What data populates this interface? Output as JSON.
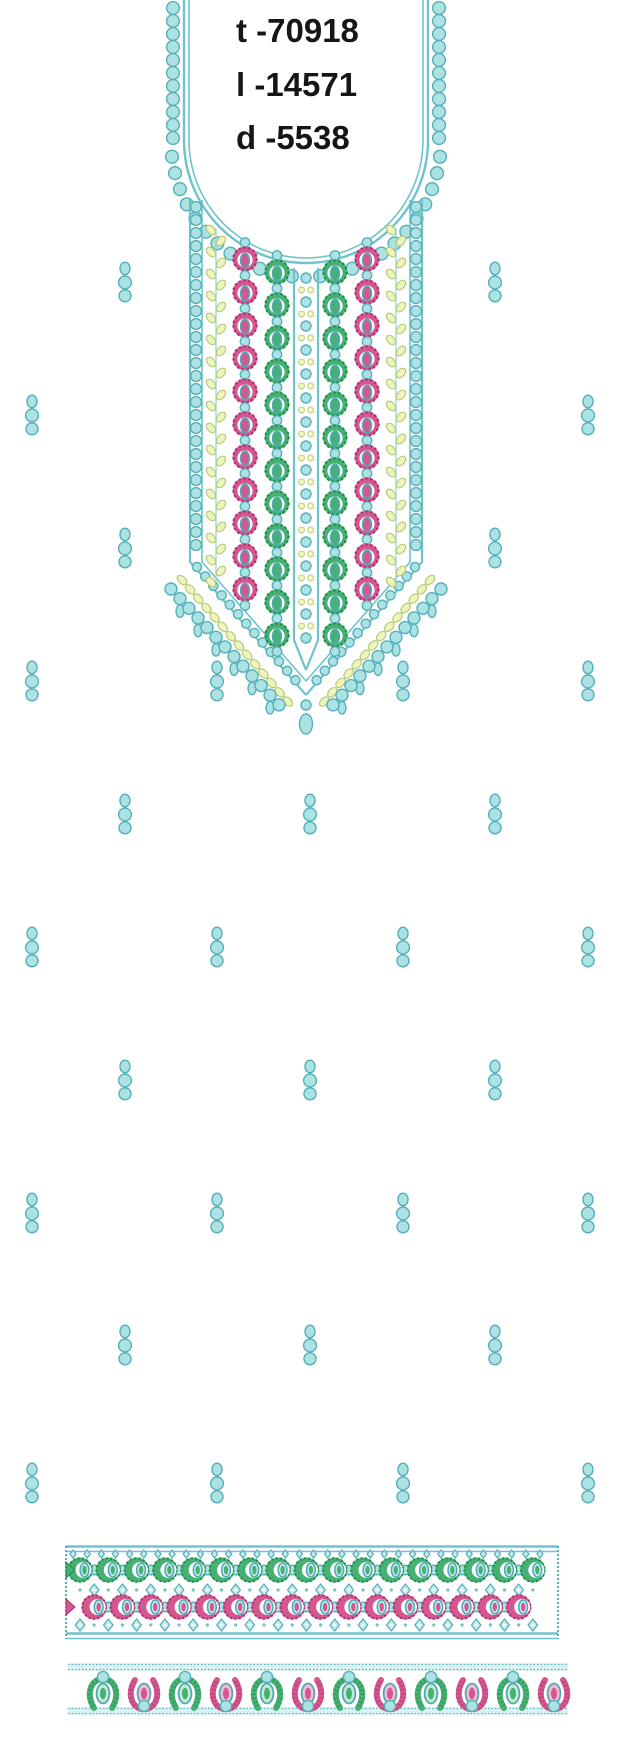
{
  "stitch_info": {
    "lines": [
      "t -70918",
      "l -14571",
      "d -5538"
    ]
  },
  "colors": {
    "background": "#ffffff",
    "text": "#161616",
    "teal_line": "#6fc3cc",
    "teal_stroke": "#4fa9b8",
    "pearl_fill": "#ace2e1",
    "pearl_stroke": "#55b0bc",
    "aqua_light": "#c2ebe9",
    "green_main": "#47b173",
    "green_dark": "#1f8a4d",
    "green_pale": "#c4ead0",
    "pink_main": "#d5578f",
    "pink_dark": "#a93070",
    "pink_pale": "#f2bcd4",
    "leaf_fill": "#eef4bb",
    "leaf_stroke": "#b6cc79",
    "yellow_dot": "#f1f6c8",
    "band_fill": "#d9f1f1"
  },
  "neckline": {
    "center_x": 306,
    "side_left_x": 184,
    "side_right_x": 428,
    "u_cy": 140,
    "u_rx": 122,
    "u_ry": 123,
    "panel_left": 190,
    "panel_right": 422,
    "panel_top": 200,
    "panel_straight_bottom": 562,
    "tip_y": 695,
    "leaf_col_xs": [
      216,
      396
    ],
    "pink_col_xs": [
      245,
      367
    ],
    "green_col_xs": [
      277,
      335
    ],
    "flower_pitch": 33,
    "pink_col_span": [
      259,
      611
    ],
    "green_col_span": [
      272,
      648
    ],
    "center_band": {
      "left": 294,
      "right": 318,
      "top": 268,
      "bottom": 640,
      "tip_y": 670
    },
    "pendant": {
      "pearl_y": 705,
      "drop_y": 724
    }
  },
  "buti_positions": [
    [
      125,
      282
    ],
    [
      495,
      282
    ],
    [
      32,
      415
    ],
    [
      588,
      415
    ],
    [
      125,
      548
    ],
    [
      495,
      548
    ],
    [
      32,
      681
    ],
    [
      217,
      681
    ],
    [
      403,
      681
    ],
    [
      588,
      681
    ],
    [
      125,
      814
    ],
    [
      310,
      814
    ],
    [
      495,
      814
    ],
    [
      32,
      947
    ],
    [
      217,
      947
    ],
    [
      403,
      947
    ],
    [
      588,
      947
    ],
    [
      125,
      1080
    ],
    [
      310,
      1080
    ],
    [
      495,
      1080
    ],
    [
      32,
      1213
    ],
    [
      217,
      1213
    ],
    [
      403,
      1213
    ],
    [
      588,
      1213
    ],
    [
      125,
      1345
    ],
    [
      310,
      1345
    ],
    [
      495,
      1345
    ],
    [
      32,
      1483
    ],
    [
      217,
      1483
    ],
    [
      403,
      1483
    ],
    [
      588,
      1483
    ]
  ],
  "main_border": {
    "x0": 66,
    "x1": 558,
    "top_lines": [
      1546.5,
      1551.5
    ],
    "bottom_lines": [
      1633.5,
      1638.5
    ],
    "small_diamond_y": 1554,
    "green_row_y": 1570,
    "mid_diamond_y": 1590,
    "pink_row_y": 1607,
    "bottom_diamond_y": 1625,
    "repeat": 28.3,
    "green_first_cx": 80,
    "green_count": 17,
    "pink_first_cx": 94.15,
    "pink_count": 16
  },
  "hem_border": {
    "x0": 68,
    "x1": 568,
    "top_band_y": 1663,
    "bottom_band_y": 1707,
    "band_h": 8,
    "green_xs": [
      103,
      185,
      267,
      349,
      431,
      513
    ],
    "pink_xs": [
      144,
      226,
      308,
      390,
      472,
      554
    ],
    "oval_y": 1693.5,
    "green_pearl_y": 1677,
    "pink_pearl_y": 1706
  }
}
